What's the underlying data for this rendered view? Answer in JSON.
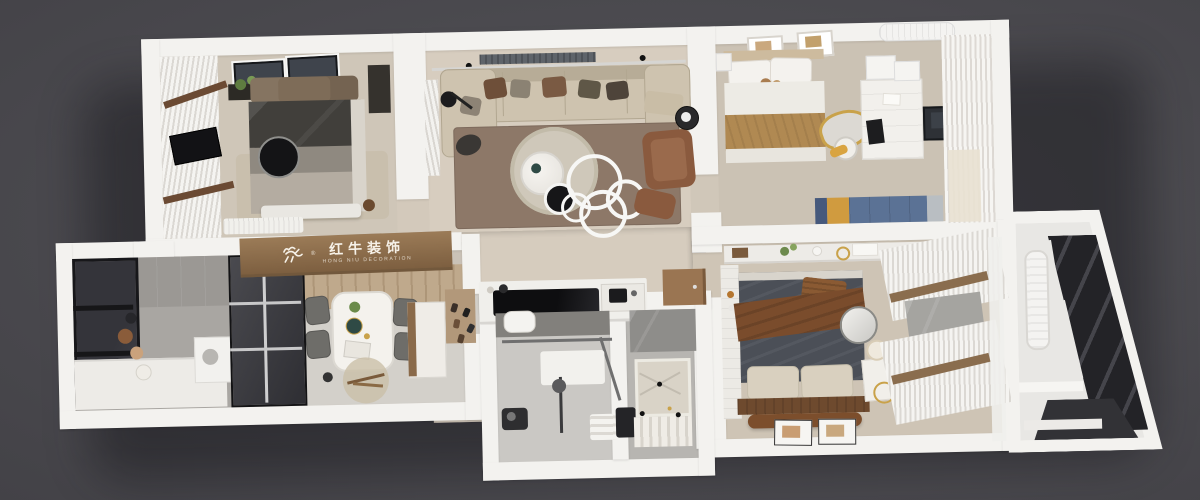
{
  "scene": {
    "type": "3d-top-down-apartment-floorplan-render",
    "background_color": "#4b4a4f",
    "rooms": [
      {
        "name": "bedroom-top-left",
        "items": [
          "striped curtain wall",
          "wall tv panel",
          "leather headboard bed",
          "round black table",
          "plant shelf",
          "bench",
          "radiator"
        ]
      },
      {
        "name": "living-room",
        "items": [
          "beige sectional sofa",
          "throw pillows",
          "brown rug",
          "round coffee tables",
          "ring chandelier",
          "leather armchair",
          "floor lamp",
          "ac vent"
        ]
      },
      {
        "name": "bedroom-top-right",
        "items": [
          "bed with teddy bears",
          "gold kidney mirror desk",
          "white desk unit",
          "tv panel",
          "curtains",
          "blue-yellow sideboard",
          "wall art",
          "ac unit"
        ]
      },
      {
        "name": "dining-kitchen",
        "items": [
          "marble dining table",
          "four gray chairs",
          "wood sideboard",
          "round rug",
          "black cooktop counter",
          "sink"
        ]
      },
      {
        "name": "balcony-left",
        "items": [
          "dark framed windows",
          "gray tile wall",
          "pots",
          "white counter",
          "washer"
        ]
      },
      {
        "name": "bathroom",
        "items": [
          "toilet",
          "glass partition",
          "shower",
          "towels",
          "marble shower tray",
          "slat mat"
        ]
      },
      {
        "name": "master-bedroom",
        "items": [
          "dark duvet bed",
          "brown throw",
          "beige pillows",
          "wood headboard",
          "round mirror",
          "nightstand with lamp",
          "curtains with wood rods",
          "decor shelf",
          "art frames on floor"
        ]
      },
      {
        "name": "balcony-right",
        "items": [
          "diagonal glazed wall",
          "white radiator",
          "steps"
        ]
      }
    ]
  },
  "watermark": {
    "brand_cn": "红牛装饰",
    "brand_en": "HONG NIU DECORATION",
    "registered": "®"
  },
  "palette": {
    "wall": "#f3f2ef",
    "floor_warm": "#d6ccbe",
    "floor_gray": "#c7c5c1",
    "wood_sign": "#8a6a4a",
    "accent_blue": "#5b7295",
    "accent_yellow": "#d09b3f",
    "accent_gold": "#c9a24a",
    "glass_dark": "#303034",
    "sofa_beige": "#cec3af",
    "rug_brown": "#8d7868",
    "bed_dark": "#4b4f57",
    "throw_brown": "#7a4c2c"
  }
}
